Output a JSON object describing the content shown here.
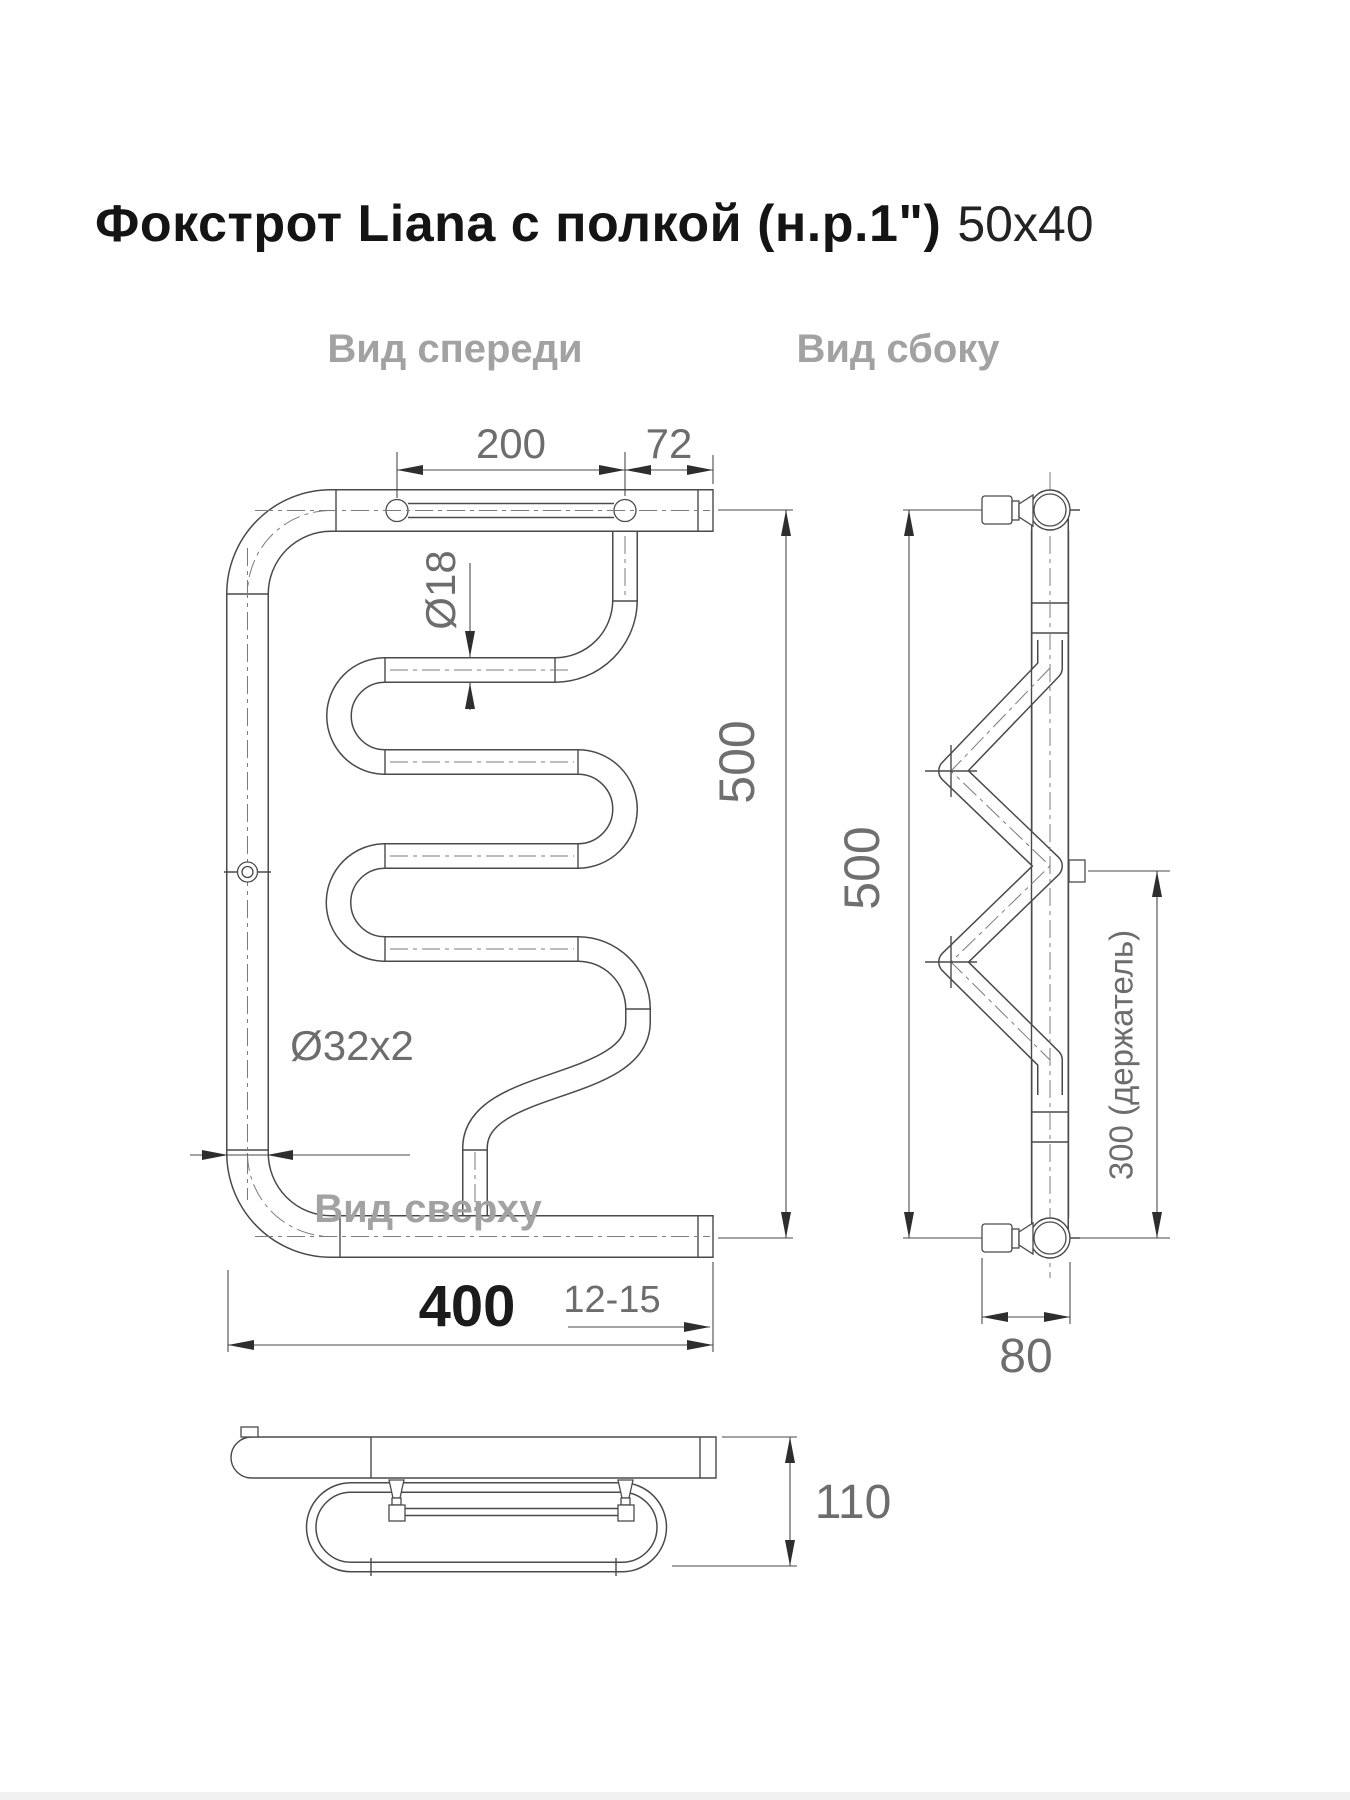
{
  "title": {
    "product": "Фокстрот Liana с полкой (н.р.1\")",
    "size": "50x40"
  },
  "drawing": {
    "line_color": "#4a4a4a",
    "dim_text_color": "#6d6d6d",
    "label_color": "#a2a2a2",
    "views": {
      "front": {
        "label": "Вид спереди",
        "dimensions": {
          "shelf_rod_length": "200",
          "shelf_overhang": "72",
          "coil_pipe_diameter": "Ø18",
          "height": "500",
          "main_pipe_diameter": "Ø32x2",
          "width": "400",
          "wall_clearance": "12-15"
        }
      },
      "side": {
        "label": "Вид сбоку",
        "dimensions": {
          "height": "500",
          "holder_spacing": "300 (держатель)",
          "depth": "80"
        }
      },
      "top": {
        "label": "Вид сверху",
        "dimensions": {
          "depth": "110"
        }
      }
    }
  }
}
